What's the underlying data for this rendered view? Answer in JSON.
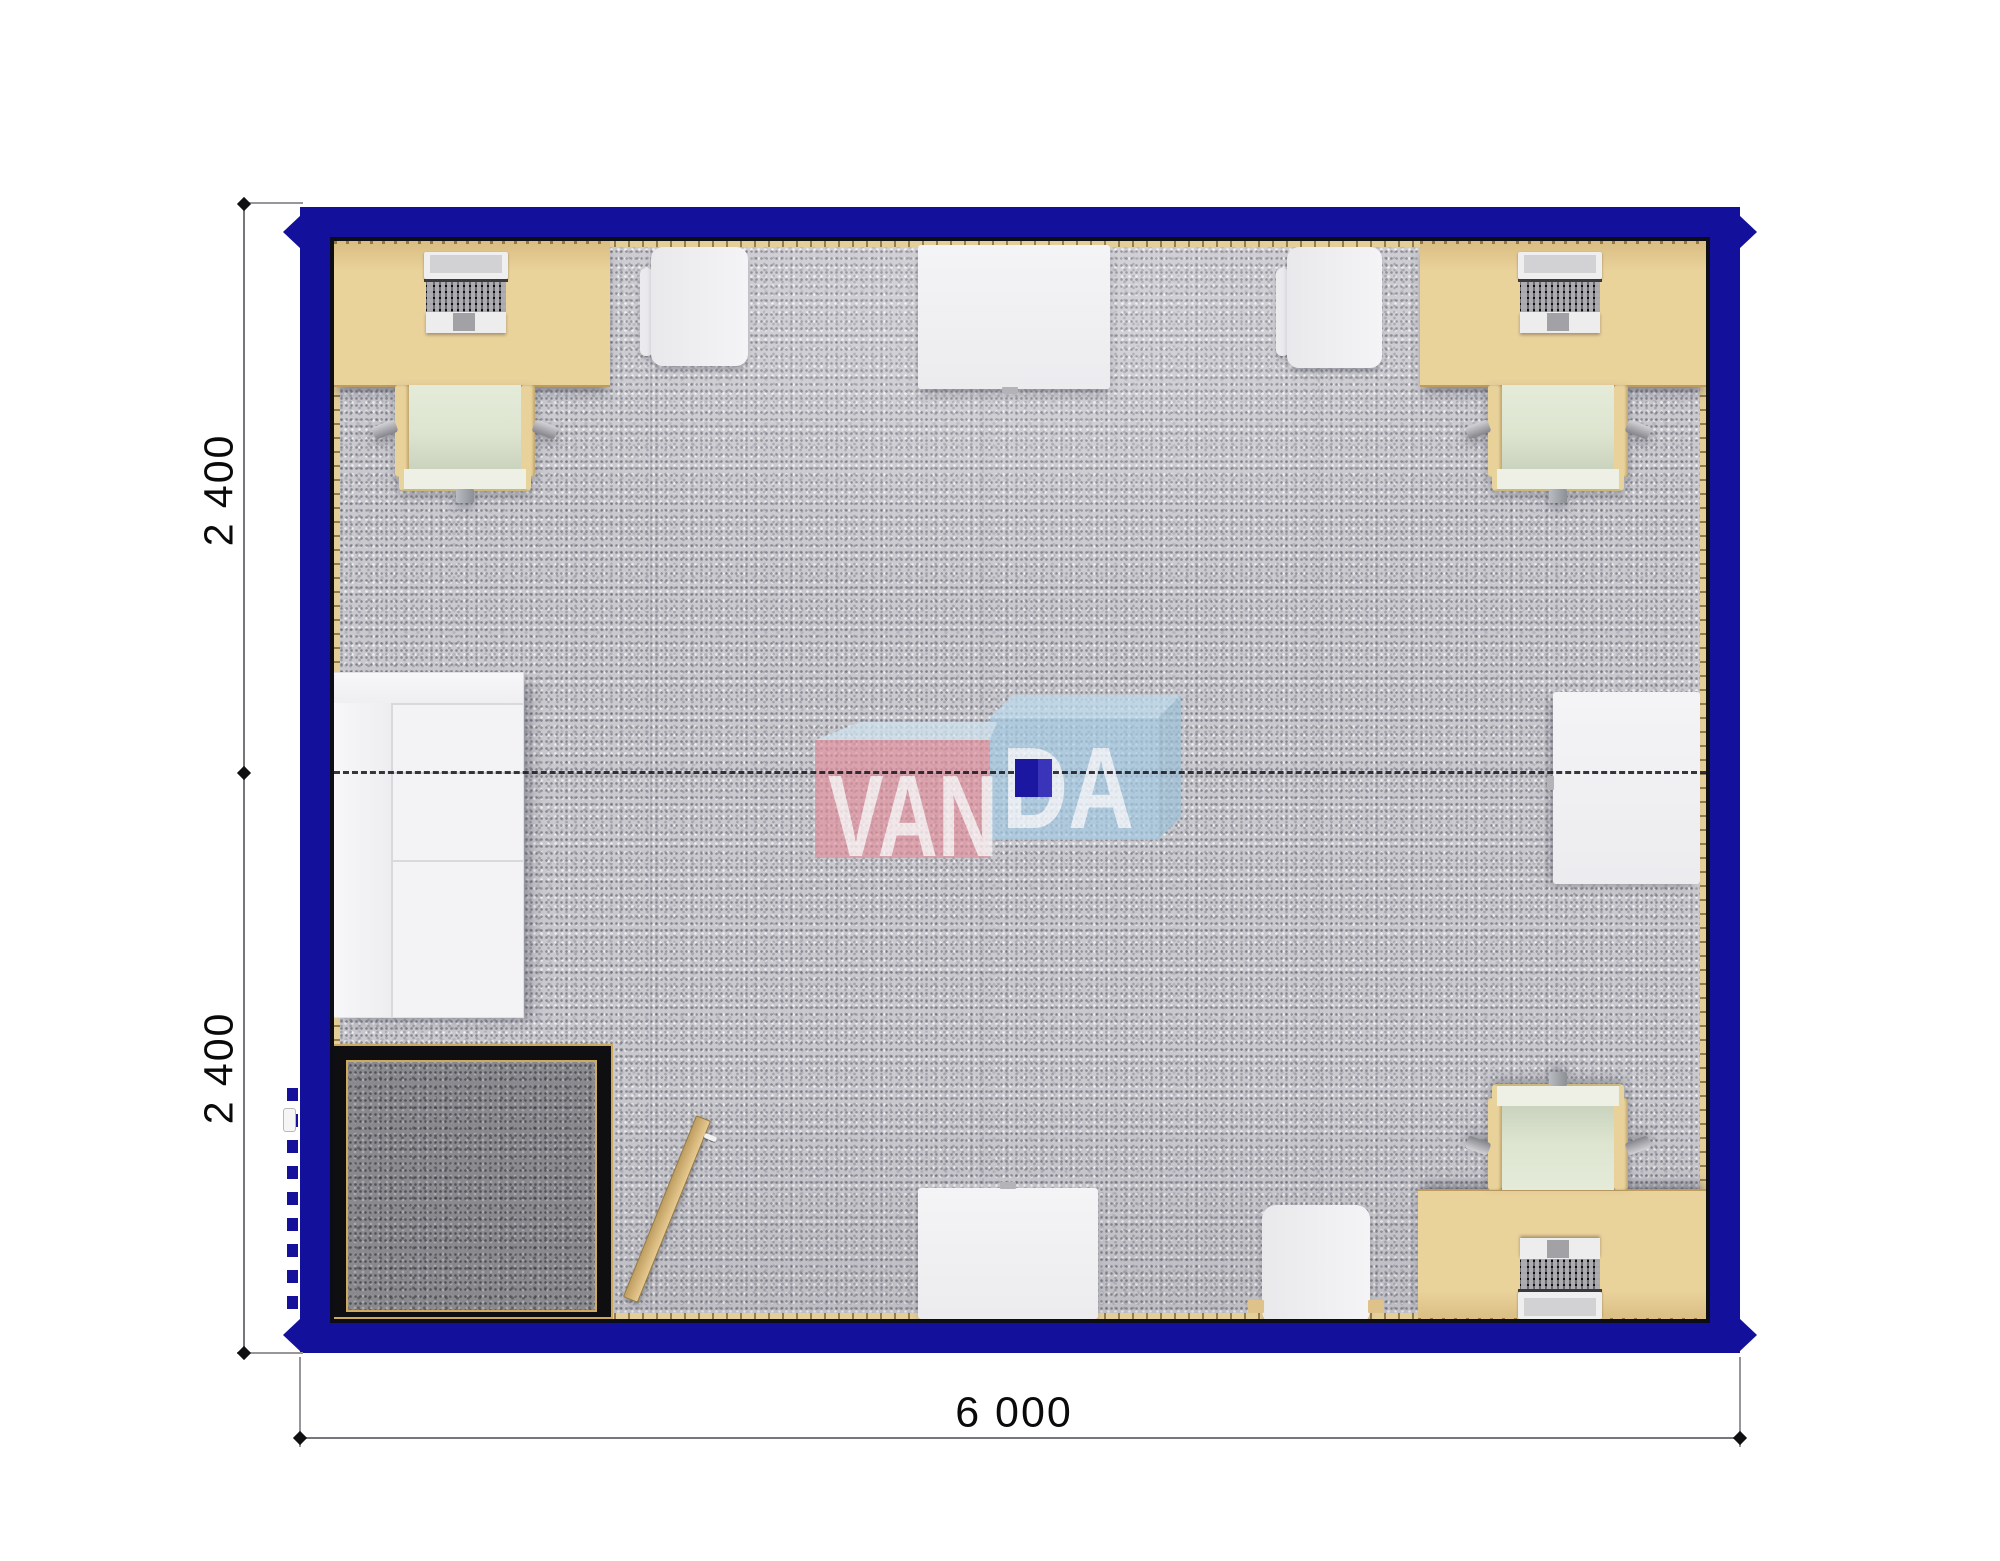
{
  "plan": {
    "type": "modular container office floor plan (top view)",
    "watermark": {
      "left": "VAN",
      "right": "DA"
    },
    "dimensions": {
      "left_upper": "2 400",
      "left_lower": "2 400",
      "bottom": "6 000"
    },
    "colors": {
      "wall_blue": "#13119c",
      "wall_inner_line": "#0d0d16",
      "floor_carpet": "#c9c9ce",
      "entry_mat": "#8a8a8e",
      "mat_frame_black": "#0f0f12",
      "mat_trim_gold": "#cfa95e",
      "desk_beige": "#ead29b",
      "skirting": "#e4cf99",
      "chair_frame": "#e8d29a",
      "chair_seat": "#dde5d1",
      "white_furniture": "#f3f3f5",
      "door_wood": "#d8b678",
      "logo_pink_cube": "#e2909c",
      "logo_blue_cube": "#a5cbe5",
      "logo_navy_block": "#1c17a0",
      "dimension_text": "#0a0a0a"
    },
    "furniture": [
      {
        "id": "desk-top-left",
        "type": "desk with laptop"
      },
      {
        "id": "office-chair-top-left",
        "type": "office chair"
      },
      {
        "id": "visitor-chair-top-left",
        "type": "armchair"
      },
      {
        "id": "meeting-table-top",
        "type": "white table"
      },
      {
        "id": "visitor-chair-top-right",
        "type": "armchair"
      },
      {
        "id": "desk-top-right",
        "type": "desk with laptop"
      },
      {
        "id": "office-chair-top-right",
        "type": "office chair"
      },
      {
        "id": "sofa-left",
        "type": "two-seat sofa"
      },
      {
        "id": "side-table-right",
        "type": "white table"
      },
      {
        "id": "entrance-mat",
        "type": "entrance mat with frame"
      },
      {
        "id": "door-leaf",
        "type": "open door leaf"
      },
      {
        "id": "meeting-table-bottom",
        "type": "white table"
      },
      {
        "id": "visitor-chair-bottom",
        "type": "armchair"
      },
      {
        "id": "desk-bottom-right",
        "type": "desk with laptop"
      },
      {
        "id": "office-chair-bottom-right",
        "type": "office chair"
      }
    ]
  }
}
